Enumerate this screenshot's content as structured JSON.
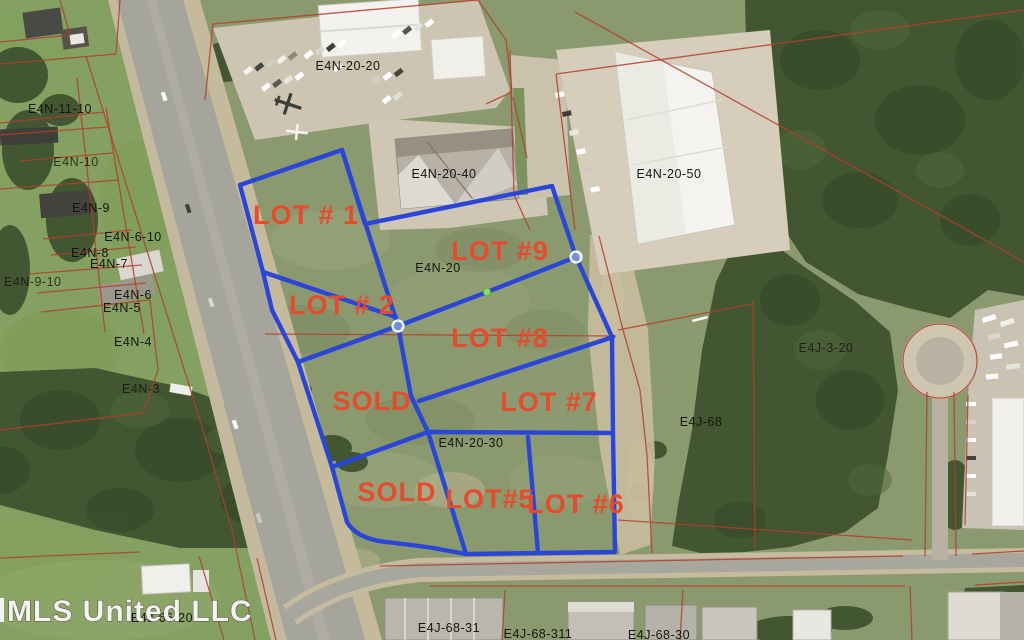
{
  "map": {
    "watermark": "MLS United LLC",
    "lot_labels": [
      "LOT # 1",
      "LOT #9",
      "LOT # 2",
      "LOT #8",
      "SOLD",
      "LOT #7",
      "SOLD",
      "LOT#5",
      "LOT #6"
    ],
    "parcel_labels": [
      "E4N-11-10",
      "E4N-10",
      "E4N-9",
      "E4N-6-10",
      "E4N-8",
      "E4N-7",
      "E4N-9-10",
      "E4N-6",
      "E4N-5",
      "E4N-4",
      "E4N-3",
      "E4N-20-20",
      "E4N-20-40",
      "E4N-20-50",
      "E4N-20",
      "E4N-20-30",
      "E4J-3-20",
      "E4J-68",
      "E4J-66-20",
      "E4J-68-31",
      "E4J-68-311",
      "E4J-68-30"
    ],
    "colors": {
      "lot_boundary_blue": "#2946d8",
      "lot_label_red": "#e84a2d",
      "parcel_line_red": "#b2402c",
      "parcel_label_black": "#15150f",
      "vertex_marker_green": "#8ade62"
    }
  }
}
